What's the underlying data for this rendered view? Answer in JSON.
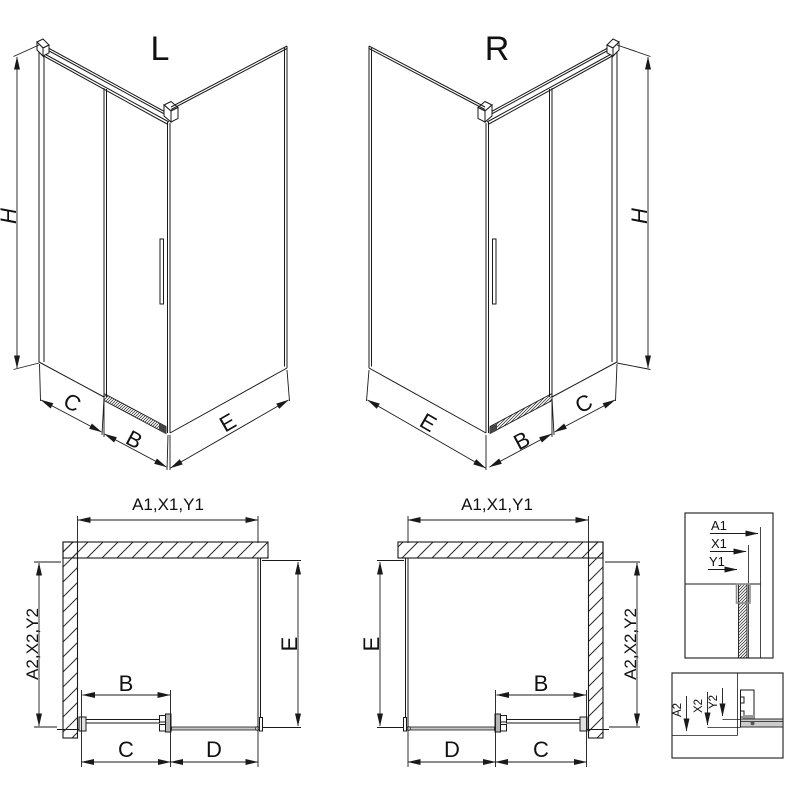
{
  "drawing": {
    "iso_left": {
      "label": "L",
      "height": "H",
      "dims": {
        "side": "C",
        "door": "B",
        "return": "E"
      }
    },
    "iso_right": {
      "label": "R",
      "height": "H",
      "dims": {
        "return": "E",
        "door": "B",
        "side": "C"
      }
    },
    "plan_left": {
      "top": "A1,X1,Y1",
      "left": "A2,X2,Y2",
      "right": "E",
      "door": "B",
      "bottom": [
        "C",
        "D"
      ]
    },
    "plan_right": {
      "top": "A1,X1,Y1",
      "left": "E",
      "right": "A2,X2,Y2",
      "door": "B",
      "bottom": [
        "D",
        "C"
      ]
    },
    "detail_top": {
      "dims": [
        "A1",
        "X1",
        "Y1"
      ]
    },
    "detail_bottom": {
      "dims": [
        "A2",
        "X2",
        "Y2"
      ]
    },
    "colors": {
      "line": "#1a1a1a",
      "profile_gray": "#9a9a9a",
      "light_gray": "#c8c8c8",
      "background": "#ffffff"
    }
  }
}
